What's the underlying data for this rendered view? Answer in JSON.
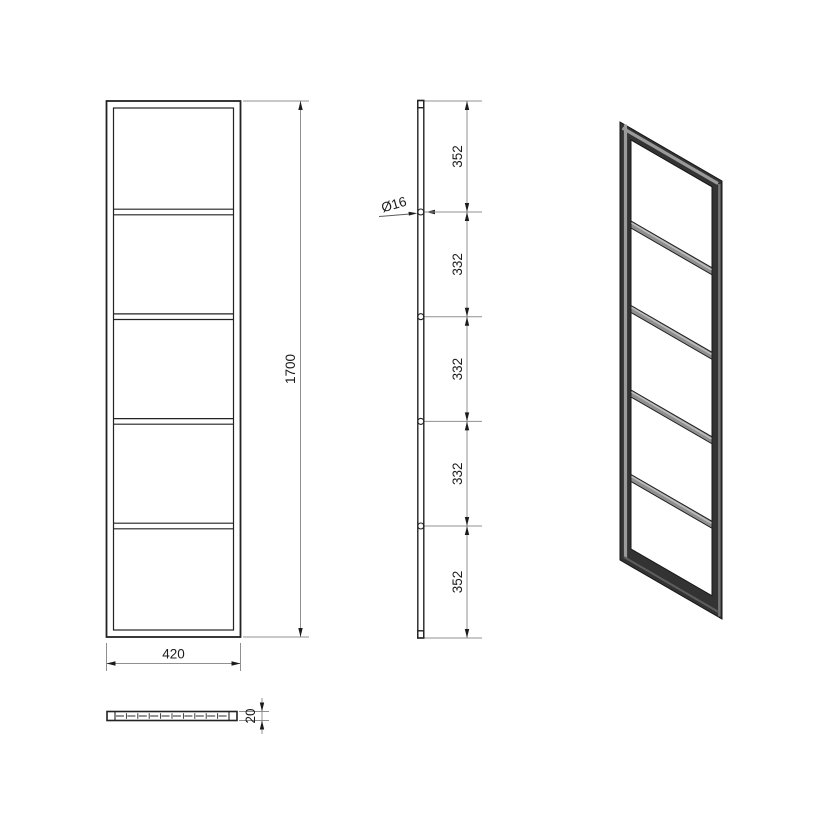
{
  "front_view": {
    "width_label": "420",
    "height_label": "1700"
  },
  "side_view": {
    "diameter_label": "Ø16",
    "segment_labels": [
      "352",
      "332",
      "332",
      "332",
      "352"
    ]
  },
  "bottom_view": {
    "thickness_label": "20"
  },
  "colors": {
    "object_line": "#222222",
    "dimension_line": "#909090",
    "text": "#1c1c1c",
    "frame_dark": "#333333",
    "frame_mid": "#8f8f8f",
    "frame_highlight": "#9a9a9a",
    "background": "#ffffff"
  }
}
